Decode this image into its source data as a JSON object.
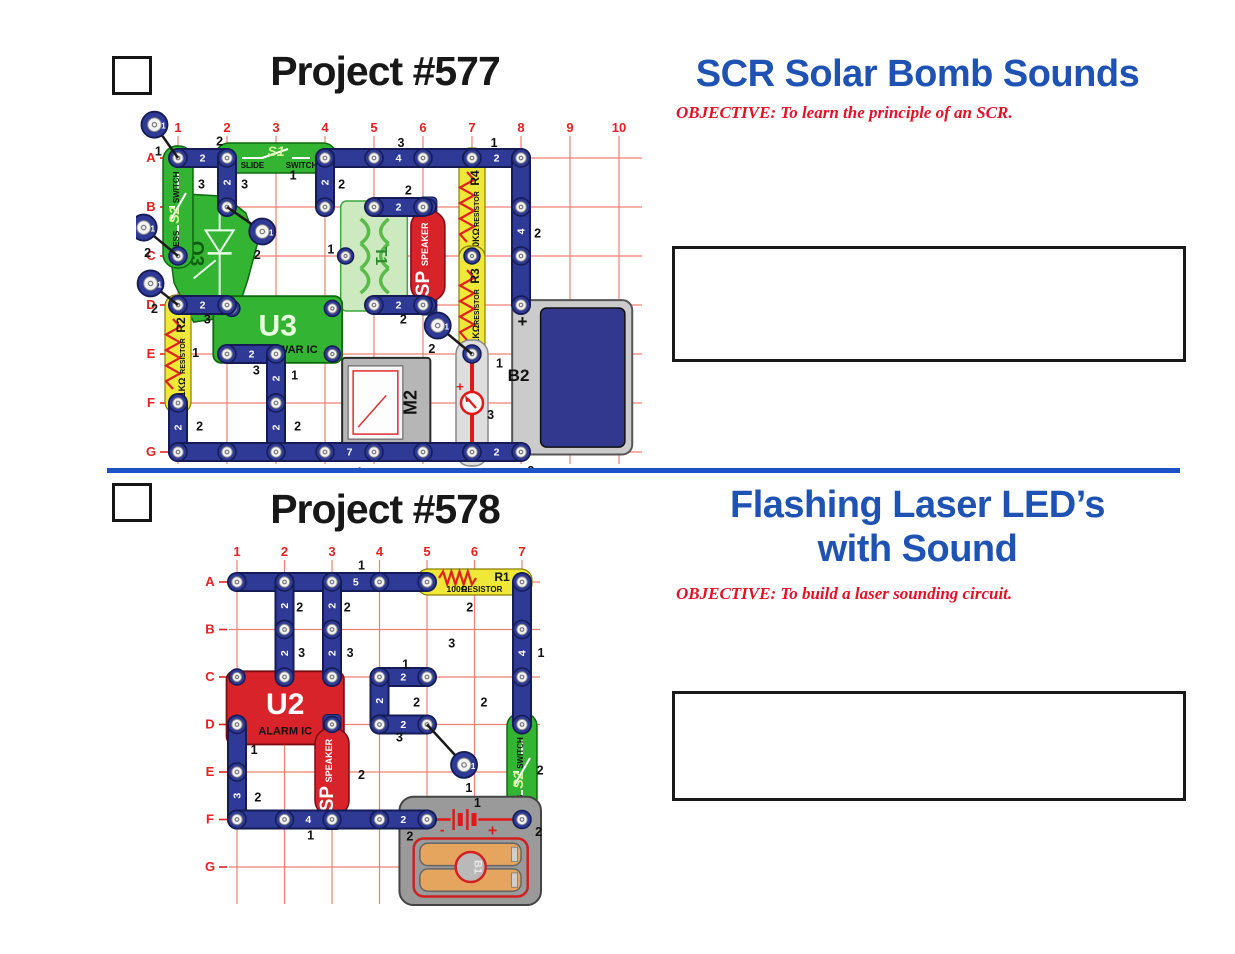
{
  "header1": {
    "number": "Project #577",
    "title": "SCR Solar Bomb Sounds",
    "objective": "OBJECTIVE:  To learn the principle of an SCR."
  },
  "header2": {
    "number": "Project #578",
    "title_line1": "Flashing Laser LED’s",
    "title_line2": "with Sound",
    "objective": "OBJECTIVE:  To build a laser sounding circuit."
  },
  "colors": {
    "headline_blue": "#1e53b4",
    "divider_blue": "#1d52c8",
    "objective_red": "#e51025",
    "grid_red": "#f08070",
    "grid_label_red": "#e82020",
    "wire_navy": "#2e3a96",
    "wire_edge": "#141b55",
    "component_green": "#33b433",
    "component_red": "#d8232a",
    "resistor_yellow": "#f0e838",
    "battery_navy": "#31388e"
  },
  "circuit1": {
    "cols": [
      "1",
      "2",
      "3",
      "4",
      "5",
      "6",
      "7",
      "8",
      "9",
      "10"
    ],
    "rows": [
      "A",
      "B",
      "C",
      "D",
      "E",
      "F",
      "G"
    ],
    "origin": [
      42,
      54
    ],
    "step": 49,
    "components": [
      {
        "kind": "scr",
        "id": "Q3",
        "pts": [
          [
            0.88,
            1.72
          ],
          [
            1.95,
            1.78
          ],
          [
            2.38,
            2.12
          ],
          [
            2.62,
            2.75
          ],
          [
            2.42,
            3.5
          ],
          [
            2.18,
            4.22
          ],
          [
            1.32,
            4.35
          ],
          [
            0.92,
            3.55
          ],
          [
            0.78,
            2.5
          ]
        ],
        "label_at": [
          1.26,
          2.95
        ],
        "sym_at": [
          1.85,
          2.6
        ]
      },
      {
        "kind": "press",
        "id": "S2",
        "sub1": "PRESS",
        "sub2": "SWITCH",
        "c": 1,
        "r1": 1,
        "r2": 3
      },
      {
        "kind": "slide",
        "id": "S1",
        "sub1": "SLIDE",
        "sub2": "SWITCH",
        "r": 1,
        "c1": 2,
        "c2": 4
      },
      {
        "kind": "transformer",
        "id": "T1",
        "c1": 4.32,
        "c2": 5.68,
        "r1": 2,
        "r2": 4,
        "snap": [
          4.42,
          3
        ]
      },
      {
        "kind": "ic",
        "id": "U3",
        "sub": "SPACE WAR IC",
        "fill": "#33b433",
        "stroke": "#0d6b0d",
        "labelFill": "#eaffdd",
        "c1": 1.72,
        "c2": 4.35,
        "r1": 3.82,
        "r2": 5.18,
        "snaps": [
          [
            2.1,
            4.07
          ],
          [
            4.15,
            4.07
          ],
          [
            4.15,
            5.0
          ]
        ]
      },
      {
        "kind": "resistorV",
        "id": "R2",
        "sub": "RESISTOR",
        "val": "1KΩ",
        "c": 1,
        "r1": 4,
        "r2": 6
      },
      {
        "kind": "resistorV",
        "id": "R4",
        "sub": "RESISTOR",
        "val": "10KΩ",
        "c": 7,
        "r1": 1,
        "r2": 3
      },
      {
        "kind": "resistorV",
        "id": "R3",
        "sub": "RESISTOR",
        "val": "5.1KΩ",
        "c": 7,
        "r1": 3,
        "r2": 5
      },
      {
        "kind": "speaker",
        "id": "SP",
        "sub": "SPEAKER",
        "c": 6.1,
        "r1": 2,
        "r2": 4
      },
      {
        "kind": "meter",
        "id": "M2",
        "c1": 4.35,
        "c2": 6.15,
        "r1": 5.08,
        "r2": 6.9
      },
      {
        "kind": "meterwire",
        "plus": "+",
        "c": 7,
        "r1": 5,
        "r2": 7
      },
      {
        "kind": "batteryB2",
        "id": "B2",
        "plus": "+",
        "c1": 7.82,
        "c2": 10.27,
        "r1": 3.9,
        "r2": 7.05,
        "ic1": 8.4,
        "ic2": 10.12,
        "ir1": 4.06,
        "ir2": 6.9,
        "label_at": [
          7.95,
          5.55
        ],
        "plus_at": [
          8.03,
          4.45
        ],
        "snaps": [
          [
            8,
            4
          ],
          [
            8,
            7
          ]
        ]
      }
    ],
    "wires": [
      [
        1,
        1,
        2,
        1,
        "2"
      ],
      [
        4,
        1,
        7,
        1,
        "4"
      ],
      [
        7,
        1,
        8,
        1,
        "2"
      ],
      [
        2,
        1,
        2,
        2,
        "2"
      ],
      [
        4,
        1,
        4,
        2,
        "2"
      ],
      [
        5,
        2,
        6,
        2,
        "2"
      ],
      [
        5,
        4,
        6,
        4,
        "2"
      ],
      [
        8,
        1,
        8,
        4,
        "4"
      ],
      [
        1,
        4,
        2,
        4,
        "2"
      ],
      [
        2,
        5,
        3,
        5,
        "2"
      ],
      [
        3,
        5,
        3,
        6,
        "2"
      ],
      [
        1,
        6,
        1,
        7,
        "2"
      ],
      [
        3,
        6,
        3,
        7,
        "2"
      ],
      [
        1,
        7,
        7,
        7,
        "7"
      ],
      [
        7,
        7,
        8,
        7,
        "2"
      ]
    ],
    "jumpers": [
      [
        0.52,
        0.32,
        1,
        1,
        "1",
        0.6,
        0.95
      ],
      [
        0.3,
        2.42,
        1,
        3,
        "2",
        0.38,
        3.02
      ],
      [
        0.44,
        3.56,
        1,
        4,
        "2",
        0.52,
        4.16
      ],
      [
        2.72,
        2.5,
        2,
        2,
        "2",
        2.62,
        3.06
      ],
      [
        6.3,
        4.42,
        7,
        5,
        "2",
        6.18,
        4.98
      ]
    ],
    "annots": [
      [
        1.85,
        0.74,
        "2"
      ],
      [
        1.48,
        1.62,
        "3"
      ],
      [
        2.36,
        1.62,
        "3"
      ],
      [
        3.35,
        1.44,
        "1"
      ],
      [
        4.34,
        1.62,
        "2"
      ],
      [
        5.55,
        0.78,
        "3"
      ],
      [
        7.45,
        0.78,
        "1"
      ],
      [
        8.34,
        2.62,
        "2"
      ],
      [
        5.7,
        1.74,
        "2"
      ],
      [
        5.6,
        4.38,
        "2"
      ],
      [
        4.12,
        2.95,
        "1"
      ],
      [
        1.6,
        4.38,
        "3"
      ],
      [
        2.6,
        5.42,
        "3"
      ],
      [
        3.38,
        5.52,
        "1"
      ],
      [
        1.36,
        5.06,
        "1"
      ],
      [
        1.44,
        6.56,
        "2"
      ],
      [
        3.44,
        6.56,
        "2"
      ],
      [
        4.7,
        7.5,
        "1"
      ],
      [
        8.2,
        7.47,
        "2"
      ],
      [
        7.38,
        6.33,
        "3"
      ],
      [
        7.56,
        5.28,
        "1"
      ]
    ]
  },
  "circuit2": {
    "cols": [
      "1",
      "2",
      "3",
      "4",
      "5",
      "6",
      "7"
    ],
    "rows": [
      "A",
      "B",
      "C",
      "D",
      "E",
      "F",
      "G"
    ],
    "origin": [
      41,
      50
    ],
    "step": 47.5,
    "components": [
      {
        "kind": "ic",
        "id": "U2",
        "sub": "ALARM IC",
        "fill": "#d8232a",
        "stroke": "#7a0c10",
        "labelFill": "#ffffff",
        "c1": 0.78,
        "c2": 3.25,
        "r1": 2.88,
        "r2": 4.42,
        "snaps": [
          [
            1,
            3
          ],
          [
            3,
            4.25
          ]
        ]
      },
      {
        "kind": "resistorH",
        "id": "R1",
        "sub": "RESISTOR",
        "val": "100Ω",
        "r": 1,
        "c1": 5,
        "c2": 7
      },
      {
        "kind": "ledV",
        "id": "D2",
        "sub": "LED",
        "plus": "+",
        "fill": "#33b433",
        "stroke": "#0d6b0d",
        "c": 5,
        "r1": 1,
        "r2": 3
      },
      {
        "kind": "ledH",
        "id": "D1",
        "sub": "LED",
        "plus": "+",
        "fill": "#d8232a",
        "stroke": "#7a0c10",
        "r": 3,
        "c1": 5,
        "c2": 7
      },
      {
        "kind": "speaker",
        "id": "SP",
        "sub": "SPEAKER",
        "c": 3,
        "r1": 4,
        "r2": 6
      },
      {
        "kind": "press",
        "id": "S2",
        "sub1": "PRESS",
        "sub2": "SWITCH",
        "c": 7,
        "r1": 4,
        "r2": 6
      },
      {
        "kind": "batteryB1",
        "id": "B1",
        "plus": "+",
        "minus": "-",
        "c1": 4.42,
        "c2": 7.4,
        "r1": 5.52,
        "r2": 7.8
      }
    ],
    "wires": [
      [
        1,
        1,
        5,
        1,
        "5"
      ],
      [
        2,
        1,
        2,
        2,
        "2"
      ],
      [
        3,
        1,
        3,
        2,
        "2"
      ],
      [
        2,
        2,
        2,
        3,
        "2"
      ],
      [
        3,
        2,
        3,
        3,
        "2"
      ],
      [
        7,
        1,
        7,
        4,
        "4"
      ],
      [
        4,
        3,
        5,
        3,
        "2"
      ],
      [
        4,
        3,
        4,
        4,
        "2"
      ],
      [
        4,
        4,
        5,
        4,
        "2"
      ],
      [
        1,
        4,
        1,
        6,
        "3"
      ],
      [
        1,
        6,
        4,
        6,
        "4"
      ],
      [
        4,
        6,
        5,
        6,
        "2"
      ]
    ],
    "jumpers": [
      [
        5.78,
        4.85,
        5,
        4,
        "1",
        5.88,
        5.42
      ]
    ],
    "annots": [
      [
        3.62,
        0.74,
        "1"
      ],
      [
        5.9,
        1.62,
        "2"
      ],
      [
        2.32,
        1.62,
        "2"
      ],
      [
        3.32,
        1.62,
        "2"
      ],
      [
        2.36,
        2.58,
        "3"
      ],
      [
        3.38,
        2.58,
        "3"
      ],
      [
        7.4,
        2.58,
        "1"
      ],
      [
        5.52,
        2.38,
        "3"
      ],
      [
        4.55,
        2.82,
        "1"
      ],
      [
        4.78,
        3.62,
        "2"
      ],
      [
        6.2,
        3.62,
        "2"
      ],
      [
        4.42,
        4.36,
        "3"
      ],
      [
        1.36,
        4.62,
        "1"
      ],
      [
        1.44,
        5.62,
        "2"
      ],
      [
        3.62,
        5.15,
        "2"
      ],
      [
        2.55,
        6.42,
        "1"
      ],
      [
        4.64,
        6.44,
        "2"
      ],
      [
        6.06,
        5.74,
        "1"
      ],
      [
        7.35,
        6.35,
        "2"
      ],
      [
        7.38,
        5.05,
        "2"
      ]
    ]
  }
}
